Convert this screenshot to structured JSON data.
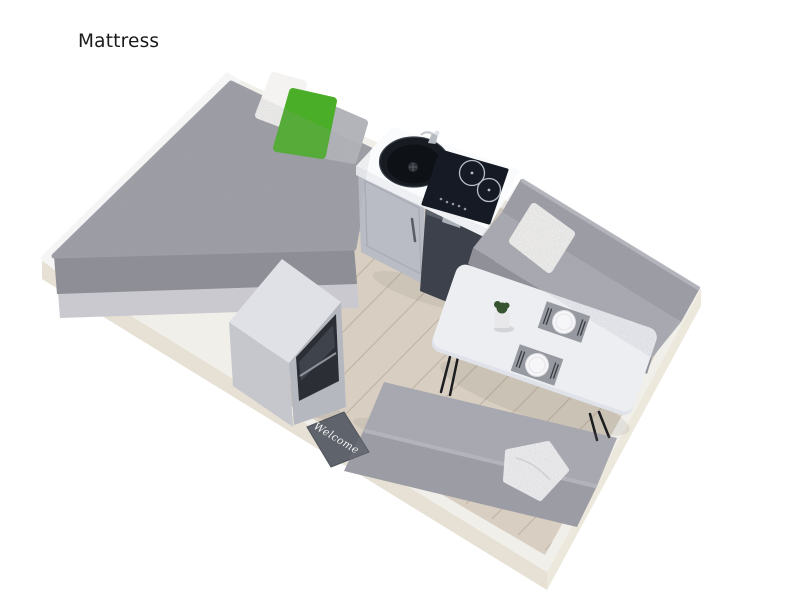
{
  "label": {
    "text": "Mattress"
  },
  "welcome_mat": {
    "text": "Welcome"
  },
  "scene": {
    "type": "3d-room-top-view-render",
    "objects": [
      "room-platform",
      "wood-floor",
      "bed-with-mattress",
      "pillow-white",
      "pillow-green",
      "pillow-gray",
      "kitchen-counter",
      "round-sink",
      "faucet",
      "induction-cooktop",
      "mini-fridge",
      "kitchen-cabinet",
      "sofa-top-right",
      "sofa-pillow-white",
      "dining-table",
      "potted-plant",
      "place-setting-1",
      "place-setting-2",
      "sofa-bottom",
      "blanket",
      "microwave-cabinet",
      "welcome-mat"
    ]
  },
  "colors": {
    "background": "#ffffff",
    "label": "#1a1a1a",
    "platform_top": "#f1efe9",
    "platform_side": "#e6e1d4",
    "platform_side2": "#ece8dc",
    "rim": "#f5f5f6",
    "floor": "#d8cfc2",
    "plank": "#bdb2a3",
    "mattress": "#9d9da5",
    "mattress_side": "#8e8e96",
    "bed_base": "#c9c9cf",
    "pillow_white": "#f4f3f1",
    "pillow_green": "#4bae28",
    "pillow_gray": "#b3b3ba",
    "counter": "#fafbfc",
    "counter_side": "#eef0f4",
    "cabinet": "#b9bcc4",
    "fridge": "#3c414b",
    "cooktop": "#151a24",
    "sink": "#181c22",
    "sink_inner": "#0e1116",
    "sofa": "#9c9da5",
    "sofa_seat": "#a9aab2",
    "sofa_dark": "#8f9098",
    "sofa_light": "#b7b8bf",
    "table": "#eceef2",
    "table_edge": "#dfe2e8",
    "leg": "#1c1d20",
    "plate": "#f6f6f8",
    "placemat": "#8d9097",
    "cutlery": "#3a3d42",
    "plant": "#36542f",
    "pot": "#e8e8ea",
    "mat": "#5f636b",
    "mat_text": "#f2f2f2",
    "blanket": "#f2f2f4"
  }
}
